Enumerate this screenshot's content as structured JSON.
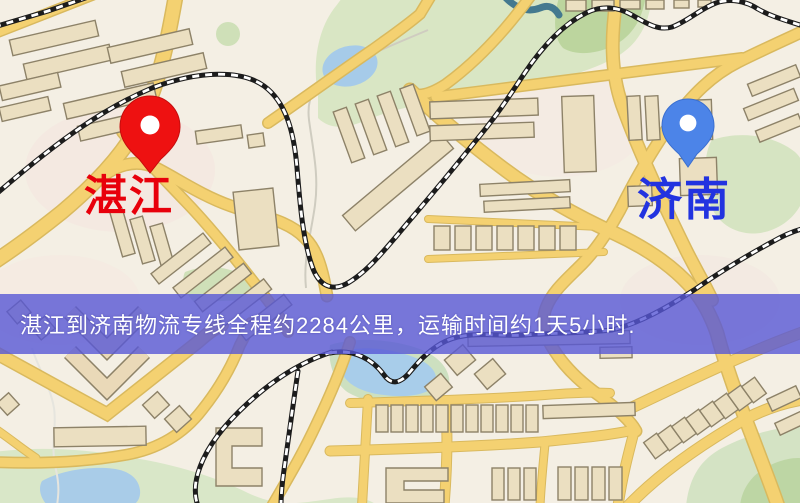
{
  "map": {
    "kind": "city-road-map",
    "colors": {
      "background": "#f4efe4",
      "road_fill": "#f4d171",
      "road_casing": "#d9b95e",
      "building_fill": "#ebdfc1",
      "building_outline": "#8d8268",
      "park_green": "#d9e6c4",
      "water_blue": "#a8cdea",
      "railway_black": "#1c1c1c",
      "railway_white": "#ffffff"
    },
    "features": [
      "roads",
      "railways",
      "buildings",
      "parks",
      "lakes",
      "streams"
    ]
  },
  "markers": {
    "origin": {
      "label": "湛江",
      "label_color": "#e8000b",
      "pin_color": "#ee1111",
      "pin_style": "red-teardrop-marker"
    },
    "destination": {
      "label": "济南",
      "label_color": "#2233e0",
      "pin_color": "#4c84e8",
      "pin_style": "blue-teardrop-marker"
    }
  },
  "banner": {
    "text": "湛江到济南物流专线全程约2284公里，运输时间约1天5小时.",
    "background": "#5858d6",
    "text_color": "#ffffff",
    "route": {
      "from": "湛江",
      "to": "济南",
      "distance_km": "2284",
      "duration": "1天5小时"
    }
  }
}
